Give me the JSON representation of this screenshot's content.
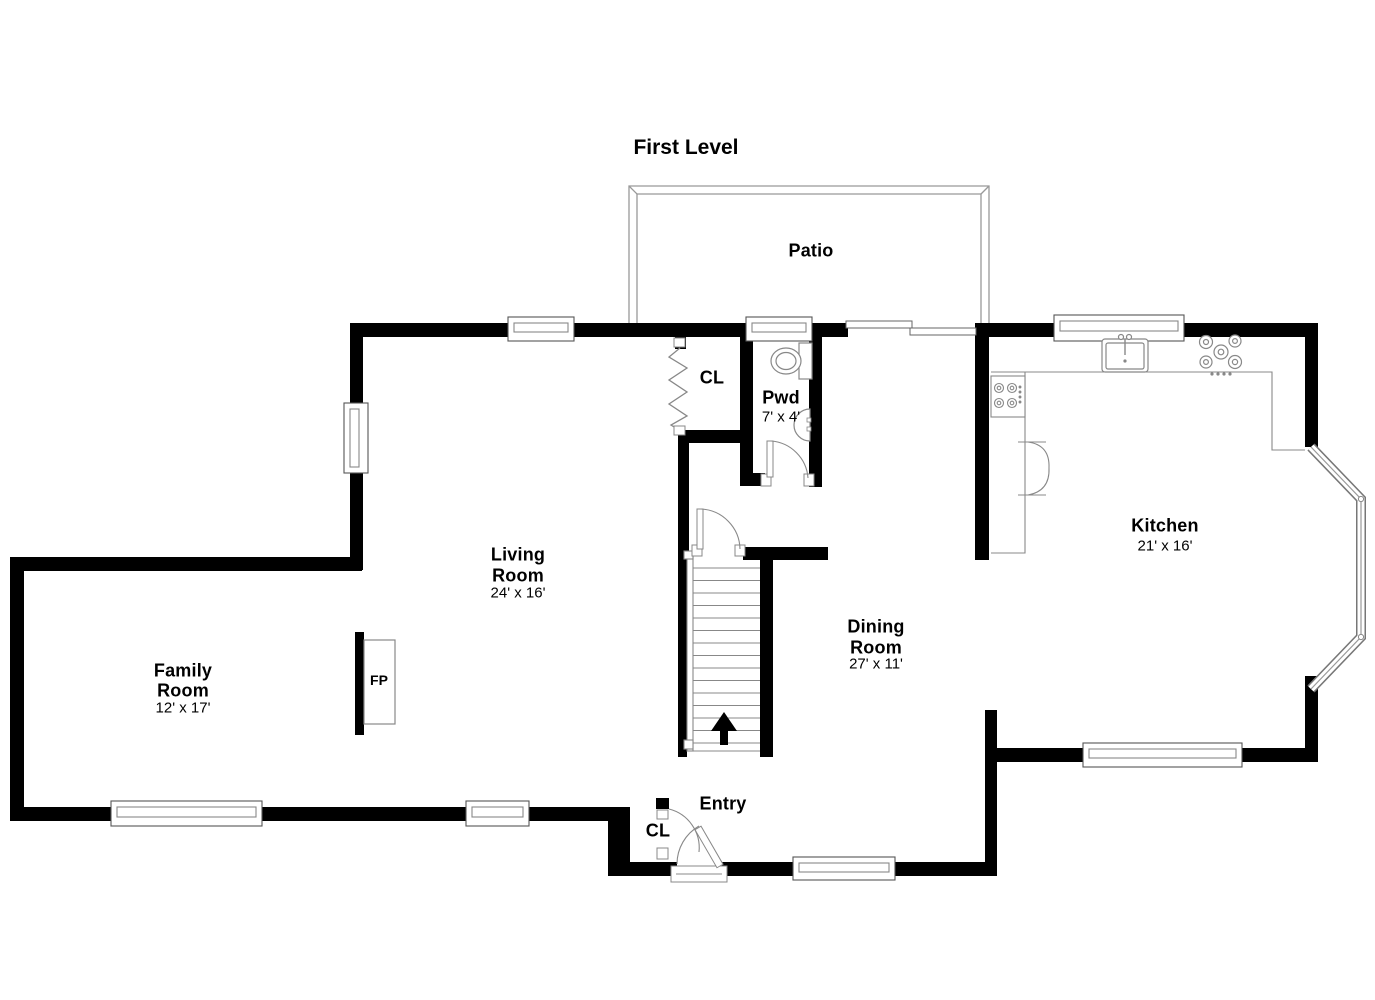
{
  "title": "First Level",
  "rooms": {
    "patio": {
      "name": "Patio"
    },
    "hall_closet": {
      "name": "CL"
    },
    "powder": {
      "name": "Pwd",
      "dims": "7' x 4'"
    },
    "living": {
      "name1": "Living",
      "name2": "Room",
      "dims": "24' x 16'"
    },
    "family": {
      "name1": "Family",
      "name2": "Room",
      "dims": "12' x 17'"
    },
    "dining": {
      "name1": "Dining",
      "name2": "Room",
      "dims": "27' x 11'"
    },
    "kitchen": {
      "name": "Kitchen",
      "dims": "21' x 16'"
    },
    "entry": {
      "name": "Entry"
    },
    "entry_closet": {
      "name": "CL"
    },
    "fireplace": {
      "name": "FP"
    }
  },
  "colors": {
    "wall": "#000000",
    "thin_line": "#888888",
    "patio_line": "#999999"
  }
}
